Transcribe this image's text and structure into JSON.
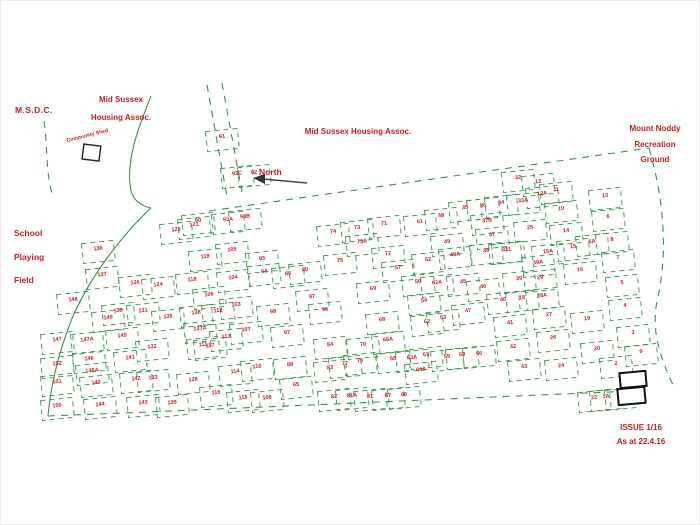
{
  "labels": {
    "msdc": "M.S.D.C.",
    "housing_left": "Mid Sussex\nHousing Assoc.",
    "housing_center": "Mid Sussex Housing Assoc.",
    "mount_noddy": "Mount Noddy\nRecreation\nGround",
    "school": "School\nPlaying\nField",
    "north": "North",
    "community_shed": "Community Shed",
    "issue": "ISSUE 1/16\nAs at 22.4.16"
  },
  "colors": {
    "plot_lines": "#3c9150",
    "labels_red": "#c32026",
    "structures_black": "#222222"
  },
  "plots": [
    {
      "n": "91",
      "x": 221,
      "y": 135
    },
    {
      "n": "93C",
      "x": 236,
      "y": 172
    },
    {
      "n": "92",
      "x": 253,
      "y": 171
    },
    {
      "n": "90",
      "x": 197,
      "y": 219
    },
    {
      "n": "93A",
      "x": 227,
      "y": 218
    },
    {
      "n": "93B",
      "x": 244,
      "y": 215
    },
    {
      "n": "121",
      "x": 193,
      "y": 223
    },
    {
      "n": "125",
      "x": 175,
      "y": 228
    },
    {
      "n": "136",
      "x": 97,
      "y": 247
    },
    {
      "n": "137",
      "x": 101,
      "y": 273
    },
    {
      "n": "126",
      "x": 134,
      "y": 281
    },
    {
      "n": "124",
      "x": 157,
      "y": 283
    },
    {
      "n": "118",
      "x": 191,
      "y": 278
    },
    {
      "n": "119",
      "x": 204,
      "y": 255
    },
    {
      "n": "105",
      "x": 231,
      "y": 248
    },
    {
      "n": "104",
      "x": 232,
      "y": 276
    },
    {
      "n": "106",
      "x": 208,
      "y": 293
    },
    {
      "n": "148",
      "x": 72,
      "y": 298
    },
    {
      "n": "149",
      "x": 107,
      "y": 316
    },
    {
      "n": "147",
      "x": 56,
      "y": 338
    },
    {
      "n": "147A",
      "x": 86,
      "y": 338
    },
    {
      "n": "152",
      "x": 56,
      "y": 362
    },
    {
      "n": "146",
      "x": 88,
      "y": 357
    },
    {
      "n": "146A",
      "x": 91,
      "y": 369
    },
    {
      "n": "151",
      "x": 56,
      "y": 380
    },
    {
      "n": "140",
      "x": 95,
      "y": 381
    },
    {
      "n": "150",
      "x": 56,
      "y": 404
    },
    {
      "n": "144",
      "x": 99,
      "y": 403
    },
    {
      "n": "130",
      "x": 117,
      "y": 309
    },
    {
      "n": "131",
      "x": 142,
      "y": 309
    },
    {
      "n": "135",
      "x": 167,
      "y": 315
    },
    {
      "n": "138",
      "x": 195,
      "y": 311
    },
    {
      "n": "145",
      "x": 121,
      "y": 334
    },
    {
      "n": "132",
      "x": 151,
      "y": 345
    },
    {
      "n": "137A",
      "x": 199,
      "y": 327
    },
    {
      "n": "117",
      "x": 209,
      "y": 344
    },
    {
      "n": "141",
      "x": 129,
      "y": 356
    },
    {
      "n": "142",
      "x": 135,
      "y": 377
    },
    {
      "n": "133",
      "x": 152,
      "y": 376
    },
    {
      "n": "128",
      "x": 192,
      "y": 378
    },
    {
      "n": "143",
      "x": 142,
      "y": 401
    },
    {
      "n": "139",
      "x": 171,
      "y": 401
    },
    {
      "n": "116",
      "x": 215,
      "y": 391
    },
    {
      "n": "112",
      "x": 217,
      "y": 309
    },
    {
      "n": "103",
      "x": 235,
      "y": 303
    },
    {
      "n": "98",
      "x": 272,
      "y": 310
    },
    {
      "n": "113",
      "x": 225,
      "y": 335
    },
    {
      "n": "107",
      "x": 245,
      "y": 328
    },
    {
      "n": "111",
      "x": 202,
      "y": 343
    },
    {
      "n": "114",
      "x": 234,
      "y": 370
    },
    {
      "n": "110",
      "x": 256,
      "y": 365
    },
    {
      "n": "115",
      "x": 242,
      "y": 396
    },
    {
      "n": "108",
      "x": 266,
      "y": 396
    },
    {
      "n": "97",
      "x": 286,
      "y": 331
    },
    {
      "n": "95",
      "x": 261,
      "y": 257
    },
    {
      "n": "94",
      "x": 263,
      "y": 270
    },
    {
      "n": "86",
      "x": 287,
      "y": 272
    },
    {
      "n": "80",
      "x": 304,
      "y": 268
    },
    {
      "n": "87",
      "x": 311,
      "y": 295
    },
    {
      "n": "96",
      "x": 324,
      "y": 308
    },
    {
      "n": "84",
      "x": 329,
      "y": 343
    },
    {
      "n": "88",
      "x": 289,
      "y": 363
    },
    {
      "n": "83",
      "x": 329,
      "y": 366
    },
    {
      "n": "82",
      "x": 333,
      "y": 395
    },
    {
      "n": "81A",
      "x": 351,
      "y": 394
    },
    {
      "n": "81",
      "x": 369,
      "y": 395
    },
    {
      "n": "77",
      "x": 344,
      "y": 362
    },
    {
      "n": "76",
      "x": 359,
      "y": 359
    },
    {
      "n": "65",
      "x": 295,
      "y": 383
    },
    {
      "n": "75",
      "x": 339,
      "y": 259
    },
    {
      "n": "74",
      "x": 332,
      "y": 230
    },
    {
      "n": "73",
      "x": 356,
      "y": 226
    },
    {
      "n": "73A",
      "x": 361,
      "y": 240
    },
    {
      "n": "71",
      "x": 383,
      "y": 222
    },
    {
      "n": "72",
      "x": 387,
      "y": 252
    },
    {
      "n": "69",
      "x": 372,
      "y": 287
    },
    {
      "n": "68",
      "x": 381,
      "y": 318
    },
    {
      "n": "70",
      "x": 362,
      "y": 343
    },
    {
      "n": "66A",
      "x": 387,
      "y": 338
    },
    {
      "n": "67",
      "x": 387,
      "y": 394
    },
    {
      "n": "66",
      "x": 403,
      "y": 393
    },
    {
      "n": "57",
      "x": 397,
      "y": 266
    },
    {
      "n": "58",
      "x": 392,
      "y": 357
    },
    {
      "n": "63A",
      "x": 411,
      "y": 356
    },
    {
      "n": "63",
      "x": 425,
      "y": 353
    },
    {
      "n": "64A",
      "x": 420,
      "y": 368
    },
    {
      "n": "55",
      "x": 446,
      "y": 355
    },
    {
      "n": "59",
      "x": 461,
      "y": 353
    },
    {
      "n": "56",
      "x": 478,
      "y": 352
    },
    {
      "n": "62",
      "x": 426,
      "y": 320
    },
    {
      "n": "53",
      "x": 442,
      "y": 316
    },
    {
      "n": "62A",
      "x": 436,
      "y": 281
    },
    {
      "n": "50",
      "x": 417,
      "y": 280
    },
    {
      "n": "52",
      "x": 427,
      "y": 258
    },
    {
      "n": "61",
      "x": 419,
      "y": 220
    },
    {
      "n": "48",
      "x": 440,
      "y": 214
    },
    {
      "n": "49",
      "x": 446,
      "y": 240
    },
    {
      "n": "48A",
      "x": 454,
      "y": 253
    },
    {
      "n": "47",
      "x": 467,
      "y": 309
    },
    {
      "n": "45",
      "x": 462,
      "y": 280
    },
    {
      "n": "46",
      "x": 482,
      "y": 285
    },
    {
      "n": "54",
      "x": 423,
      "y": 299
    },
    {
      "n": "38",
      "x": 485,
      "y": 249
    },
    {
      "n": "37",
      "x": 491,
      "y": 233
    },
    {
      "n": "37B",
      "x": 486,
      "y": 219
    },
    {
      "n": "31",
      "x": 504,
      "y": 248
    },
    {
      "n": "35",
      "x": 464,
      "y": 206
    },
    {
      "n": "36",
      "x": 482,
      "y": 204
    },
    {
      "n": "34",
      "x": 500,
      "y": 201
    },
    {
      "n": "33A",
      "x": 522,
      "y": 199
    },
    {
      "n": "32",
      "x": 517,
      "y": 176
    },
    {
      "n": "12",
      "x": 537,
      "y": 180
    },
    {
      "n": "12A",
      "x": 541,
      "y": 192
    },
    {
      "n": "11",
      "x": 555,
      "y": 188
    },
    {
      "n": "10",
      "x": 560,
      "y": 207
    },
    {
      "n": "13",
      "x": 604,
      "y": 194
    },
    {
      "n": "25",
      "x": 529,
      "y": 226
    },
    {
      "n": "21",
      "x": 507,
      "y": 248
    },
    {
      "n": "15A",
      "x": 547,
      "y": 250
    },
    {
      "n": "15",
      "x": 572,
      "y": 245
    },
    {
      "n": "14",
      "x": 565,
      "y": 229
    },
    {
      "n": "6A",
      "x": 591,
      "y": 240
    },
    {
      "n": "6",
      "x": 607,
      "y": 215
    },
    {
      "n": "8",
      "x": 611,
      "y": 238
    },
    {
      "n": "7",
      "x": 617,
      "y": 256
    },
    {
      "n": "16",
      "x": 579,
      "y": 268
    },
    {
      "n": "5",
      "x": 621,
      "y": 281
    },
    {
      "n": "39A",
      "x": 537,
      "y": 261
    },
    {
      "n": "39",
      "x": 518,
      "y": 277
    },
    {
      "n": "29",
      "x": 539,
      "y": 276
    },
    {
      "n": "28A",
      "x": 541,
      "y": 294
    },
    {
      "n": "18",
      "x": 521,
      "y": 296
    },
    {
      "n": "40",
      "x": 502,
      "y": 298
    },
    {
      "n": "27",
      "x": 548,
      "y": 313
    },
    {
      "n": "41",
      "x": 509,
      "y": 321
    },
    {
      "n": "19",
      "x": 586,
      "y": 317
    },
    {
      "n": "26",
      "x": 552,
      "y": 336
    },
    {
      "n": "4",
      "x": 624,
      "y": 304
    },
    {
      "n": "3",
      "x": 632,
      "y": 331
    },
    {
      "n": "42",
      "x": 512,
      "y": 345
    },
    {
      "n": "20",
      "x": 596,
      "y": 347
    },
    {
      "n": "43",
      "x": 523,
      "y": 365
    },
    {
      "n": "24",
      "x": 560,
      "y": 364
    },
    {
      "n": "2",
      "x": 615,
      "y": 362
    },
    {
      "n": "22",
      "x": 593,
      "y": 396
    },
    {
      "n": "1A",
      "x": 605,
      "y": 395
    },
    {
      "n": "1",
      "x": 620,
      "y": 394
    },
    {
      "n": "9",
      "x": 640,
      "y": 350
    }
  ]
}
